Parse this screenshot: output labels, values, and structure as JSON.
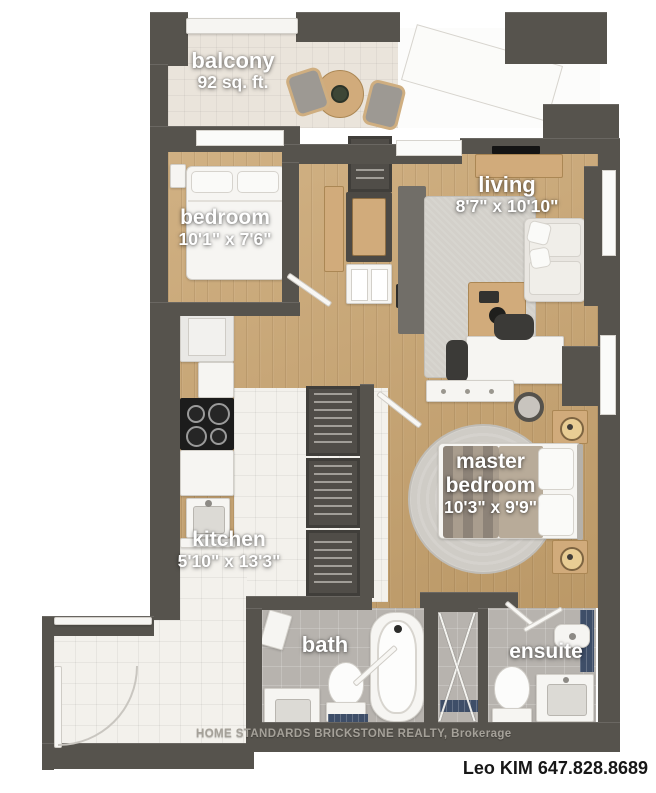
{
  "rooms": {
    "balcony": {
      "name": "balcony",
      "area": "92 sq. ft."
    },
    "bedroom": {
      "name": "bedroom",
      "dimensions": "10'1\" x 7'6\""
    },
    "living": {
      "name": "living",
      "dimensions": "8'7\" x 10'10\""
    },
    "master_bedroom": {
      "name_line1": "master",
      "name_line2": "bedroom",
      "dimensions": "10'3\" x 9'9\""
    },
    "kitchen": {
      "name": "kitchen",
      "dimensions": "5'10\" x 13'3\""
    },
    "bath": {
      "name": "bath"
    },
    "ensuite": {
      "name": "ensuite"
    }
  },
  "footer": {
    "watermark": "HOME STANDARDS BRICKSTONE REALTY, Brokerage",
    "agent_contact": "Leo KIM 647.828.8689"
  },
  "colors": {
    "wall": "#56534d",
    "wood_floor": "#c9a46f",
    "white_tile": "#f3f1ec",
    "grey_tile": "#b7b3ae",
    "balcony_tile": "#eae4db",
    "accent_navy_tile": "#3e4e68",
    "label_text": "#ffffff",
    "agent_text": "#171717"
  }
}
